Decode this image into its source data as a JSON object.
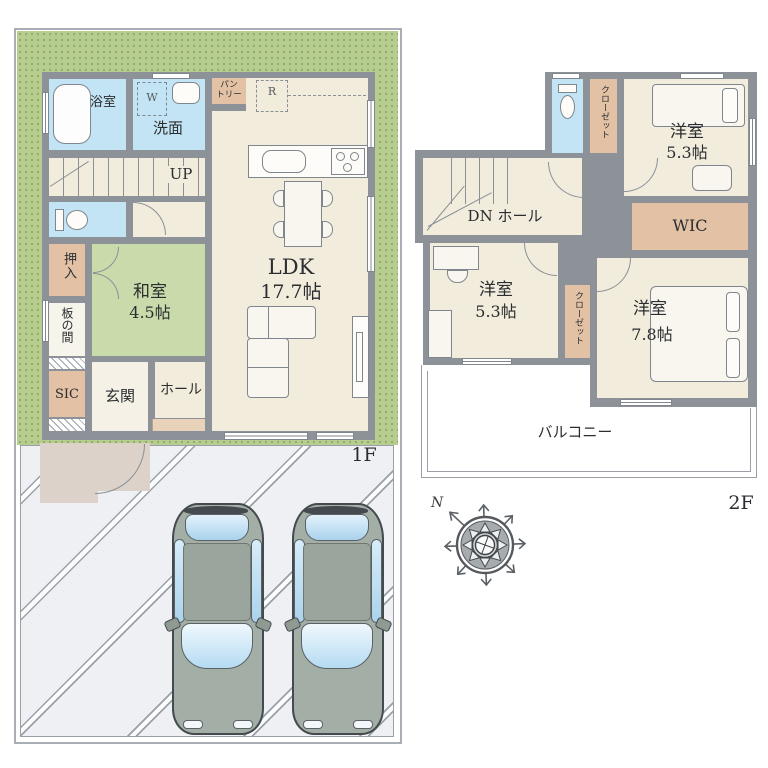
{
  "colors": {
    "wall": "#8d9299",
    "floor": "#f2ecdd",
    "tatami": "#c9dbaa",
    "water_blue": "#c3e4f4",
    "closet_tan": "#e2c1a5",
    "garden_green": "#b7cd90",
    "driveway": "#eef0f3",
    "approach": "#dcd2c9"
  },
  "floor1": {
    "label": "1F",
    "bathroom": "浴室",
    "washroom": "洗面",
    "washer": "W",
    "stairs_up": "UP",
    "pantry_line1": "パン",
    "pantry_line2": "トリー",
    "fridge": "R",
    "oshiire": "押入",
    "washitsu_name": "和室",
    "washitsu_size": "4.5帖",
    "itanoma": "板の間",
    "sic": "SIC",
    "genkan": "玄関",
    "hall": "ホール",
    "ldk_name": "LDK",
    "ldk_size": "17.7帖"
  },
  "floor2": {
    "label": "2F",
    "closet_top": "クローゼット",
    "bedroom_top_name": "洋室",
    "bedroom_top_size": "5.3帖",
    "wic": "WIC",
    "dn_hall": "DN ホール",
    "bedroom_left_name": "洋室",
    "bedroom_left_size": "5.3帖",
    "closet_mid": "クローゼット",
    "bedroom_right_name": "洋室",
    "bedroom_right_size": "7.8帖",
    "balcony": "バルコニー"
  },
  "compass": {
    "north": "N"
  }
}
